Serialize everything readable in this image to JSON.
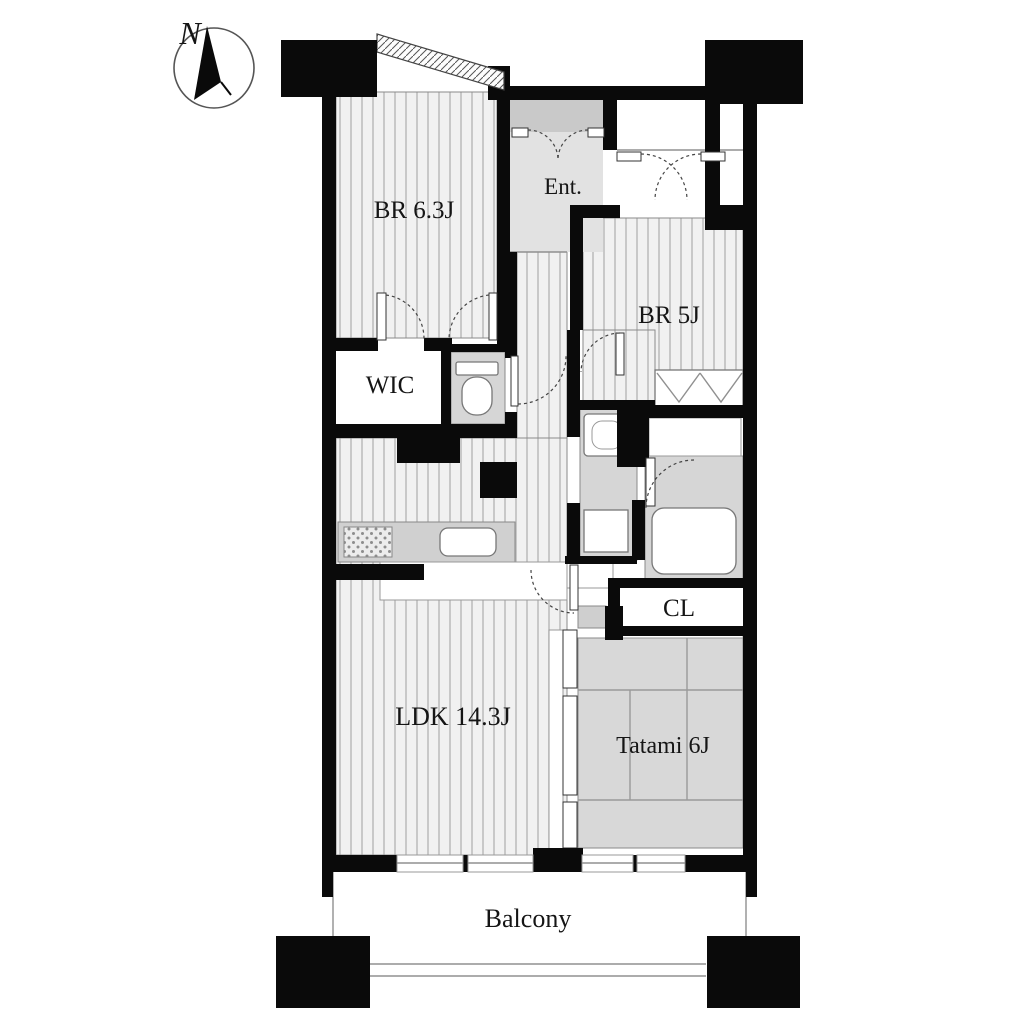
{
  "title": "Apartment floor plan",
  "compass": {
    "label": "N"
  },
  "rooms": {
    "bedroom1": {
      "label": "BR 6.3J"
    },
    "entrance": {
      "label": "Ent."
    },
    "bedroom2": {
      "label": "BR 5J"
    },
    "wic": {
      "label": "WIC"
    },
    "closet": {
      "label": "CL"
    },
    "ldk": {
      "label": "LDK 14.3J"
    },
    "tatami": {
      "label": "Tatami 6J"
    },
    "balcony": {
      "label": "Balcony"
    }
  },
  "colors": {
    "wall": "#0a0a0a",
    "floorbg": "#f1f1f1",
    "floorline": "#b3b3b3",
    "wet": "#d6d6d6",
    "tatami": "#d8d8d8",
    "genkan": "#e2e2e2",
    "porch": "#c9c9c9",
    "counter": "#d0d0d0",
    "outline": "#8a8a8a",
    "text": "#151515"
  }
}
